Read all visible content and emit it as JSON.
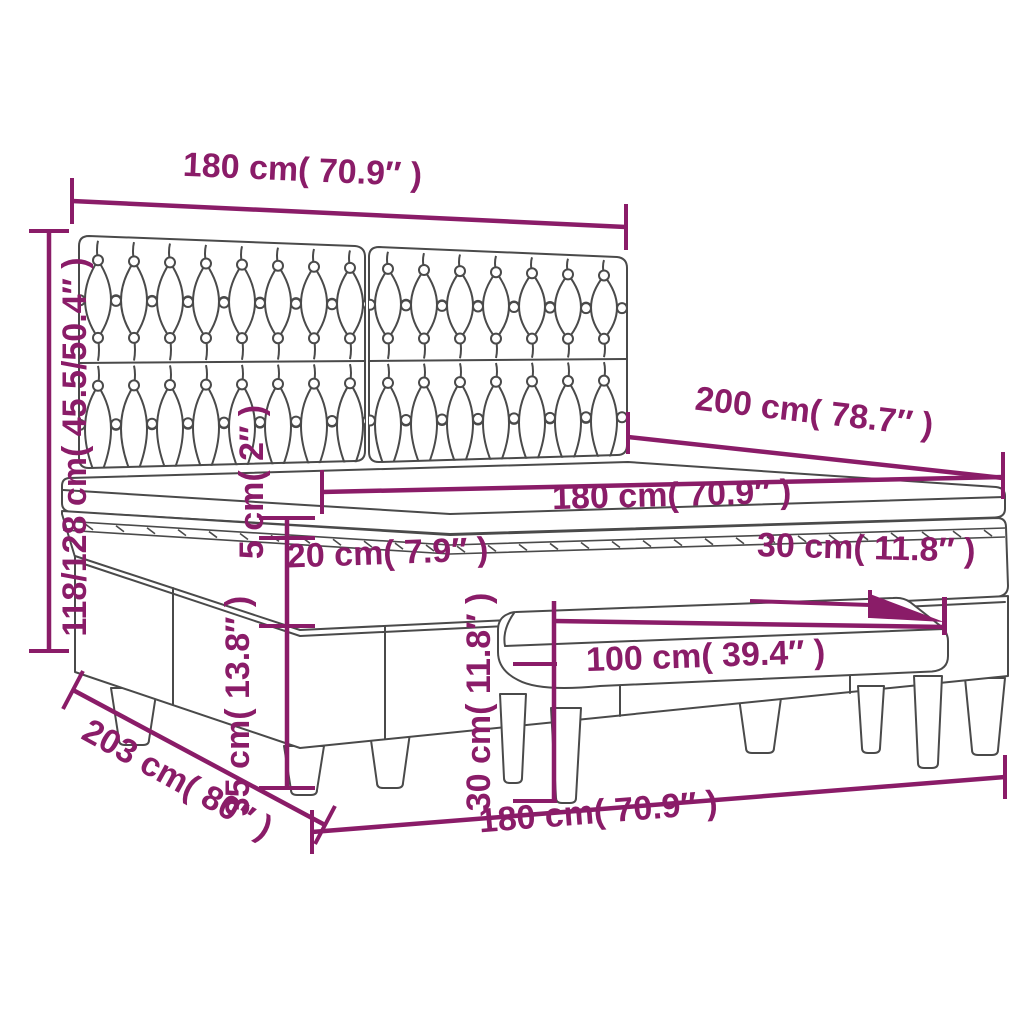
{
  "colors": {
    "dimension_accent": "#8a1c68",
    "lineart": "#4a4a4a",
    "background": "#ffffff"
  },
  "dimensions": {
    "headboard_width": "180 cm( 70.9″ )",
    "total_height": "118/128 cm( 45.5/50.4″ )",
    "bed_length": "200 cm( 78.7″ )",
    "mattress_width": "180 cm( 70.9″ )",
    "topper_thickness": "5 cm( 2″ )",
    "mattress_thickness": "20 cm( 7.9″ )",
    "bench_seat_depth": "30 cm( 11.8″ )",
    "bench_height": "30 cm( 11.8″ )",
    "bench_width": "100 cm( 39.4″ )",
    "base_with_legs_height": "35 cm( 13.8″ )",
    "bed_depth": "203 cm( 80″ )",
    "bed_width": "180 cm( 70.9″ )"
  }
}
